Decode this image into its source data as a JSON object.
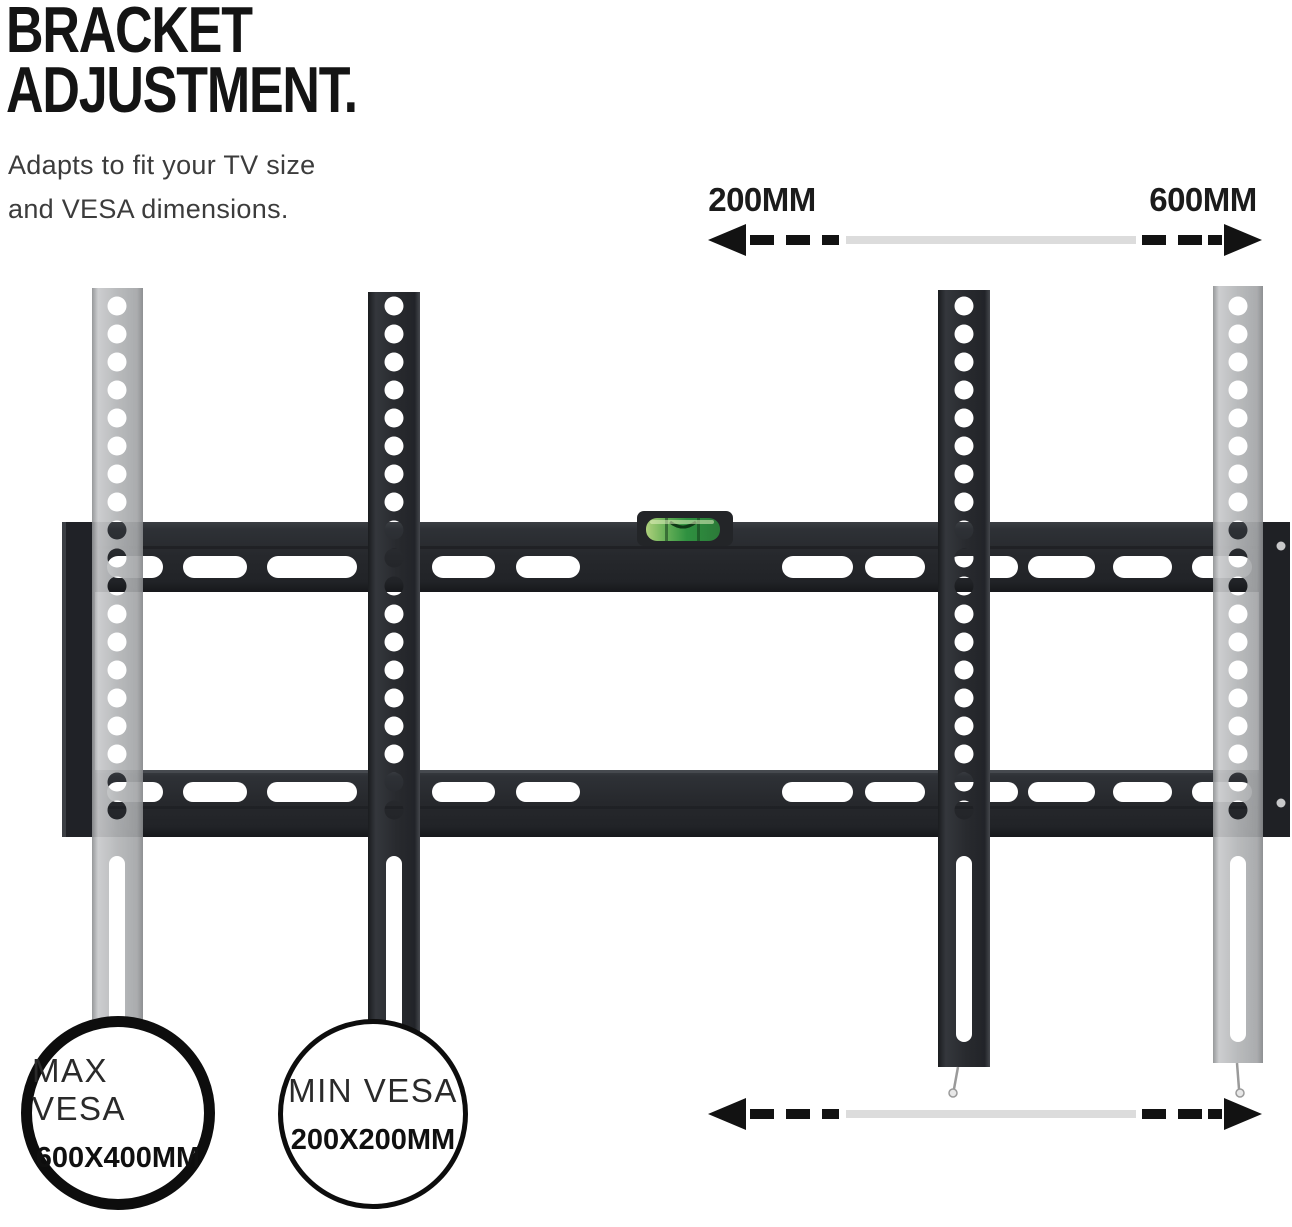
{
  "header": {
    "title_line1": "BRACKET",
    "title_line2": "ADJUSTMENT.",
    "subtitle_line1": "Adapts to fit your TV size",
    "subtitle_line2": "and VESA dimensions."
  },
  "dimension_arrows": {
    "top": {
      "min_label": "200MM",
      "max_label": "600MM"
    },
    "bottom": {}
  },
  "badges": {
    "max_vesa": {
      "label": "MAX VESA",
      "value": "600X400MM"
    },
    "min_vesa": {
      "label": "MIN VESA",
      "value": "200X200MM"
    }
  },
  "colors": {
    "bracket_dark": "#26282c",
    "bracket_gray": "#b2b4b6",
    "spirit_level_green": "#379a41",
    "arrow_dash_black": "#121212",
    "arrow_line_gray": "#dcdcdc",
    "title_text": "#141414",
    "subtitle_text": "#3c3c3c"
  }
}
